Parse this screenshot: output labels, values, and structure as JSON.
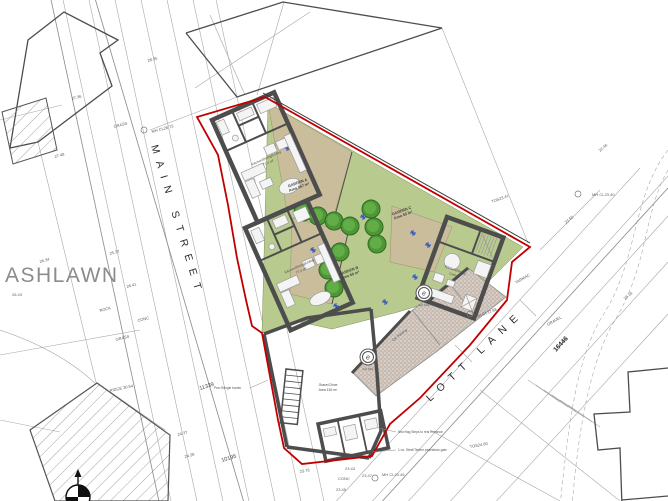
{
  "drawing": {
    "place_label": "ASHLAWN",
    "streets": [
      {
        "label": "MAIN STREET"
      },
      {
        "label": "LOTT LANE"
      }
    ],
    "chainage": [
      {
        "label": "16446"
      },
      {
        "label": "11339"
      },
      {
        "label": "10195"
      }
    ],
    "gardens": [
      {
        "name": "GARDEN A",
        "area": "Area 157 m²"
      },
      {
        "name": "GARDEN B",
        "area": "Area 60 m²"
      },
      {
        "name": "GARDEN C",
        "area": "Area 55 m²"
      }
    ],
    "rooms": {
      "house_a": {
        "line1": "Kitchen/Dining/Living",
        "line2": "77.4 m²"
      },
      "house_b": {
        "line1": "Kitchen/Dining/Living",
        "line2": "77.4 m²"
      },
      "house_c": {
        "line1": "Kitchen/Dining",
        "line2": "Living"
      },
      "yard": {
        "line1": "Gravel Drive",
        "line2": "Area 152 m²"
      }
    },
    "parking": {
      "space_symbol": "e",
      "area_label": "Car Parking",
      "space_label": "Car Park"
    },
    "callouts": [
      {
        "text": "Pea Shingle border"
      },
      {
        "text": "New flag Steps to rear entrance"
      },
      {
        "text": "1 no. Steel/Timber pedestrian gate"
      }
    ],
    "survey_labels": [
      {
        "t": "27.36",
        "x": 72,
        "y": 100,
        "r": -15
      },
      {
        "t": "27.48",
        "x": 55,
        "y": 158,
        "r": -15
      },
      {
        "t": "GRASS",
        "x": 114,
        "y": 128,
        "r": -15
      },
      {
        "t": "MH CL28.73",
        "x": 152,
        "y": 133,
        "r": -15
      },
      {
        "t": "28.35",
        "x": 148,
        "y": 62,
        "r": -15
      },
      {
        "t": "25.37",
        "x": 110,
        "y": 255,
        "r": -15
      },
      {
        "t": "26.34",
        "x": 40,
        "y": 263,
        "r": -15
      },
      {
        "t": "26.43",
        "x": 12,
        "y": 296,
        "r": 0
      },
      {
        "t": "26.41",
        "x": 127,
        "y": 288,
        "r": -15
      },
      {
        "t": "ROCK",
        "x": 100,
        "y": 312,
        "r": -15
      },
      {
        "t": "CONC",
        "x": 138,
        "y": 322,
        "r": -15
      },
      {
        "t": "GRASS",
        "x": 116,
        "y": 341,
        "r": -15
      },
      {
        "t": "RIDGE 30.54",
        "x": 110,
        "y": 392,
        "r": -12
      },
      {
        "t": "24.37",
        "x": 178,
        "y": 436,
        "r": -15
      },
      {
        "t": "24.28",
        "x": 185,
        "y": 458,
        "r": -15
      },
      {
        "t": "23.78",
        "x": 300,
        "y": 473,
        "r": -10
      },
      {
        "t": "23.43",
        "x": 345,
        "y": 470,
        "r": 0
      },
      {
        "t": "CONC",
        "x": 338,
        "y": 480,
        "r": 0
      },
      {
        "t": "23.47",
        "x": 362,
        "y": 477,
        "r": 0
      },
      {
        "t": "MH CL23.45",
        "x": 382,
        "y": 476,
        "r": 0
      },
      {
        "t": "23.45",
        "x": 336,
        "y": 491,
        "r": 0
      },
      {
        "t": "TOS23.41",
        "x": 492,
        "y": 203,
        "r": -20
      },
      {
        "t": "MH CL23.40",
        "x": 592,
        "y": 196,
        "r": 0
      },
      {
        "t": "23.55",
        "x": 566,
        "y": 224,
        "r": -40
      },
      {
        "t": "TARMAC",
        "x": 516,
        "y": 284,
        "r": -30
      },
      {
        "t": "GRAVEL",
        "x": 548,
        "y": 326,
        "r": -30
      },
      {
        "t": "MH CL22.88",
        "x": 476,
        "y": 318,
        "r": -20
      },
      {
        "t": "22.46",
        "x": 600,
        "y": 152,
        "r": -40
      },
      {
        "t": "23.18",
        "x": 625,
        "y": 300,
        "r": -40
      },
      {
        "t": "TOS24.60",
        "x": 470,
        "y": 448,
        "r": -10
      }
    ],
    "colors": {
      "boundary_red": "#c00000",
      "garden_green": "#b9ca8f",
      "garden_tan": "#c9bd9c",
      "parking_brown": "#c7bab1",
      "wall_grey": "#4d4d4d",
      "tree_green": "#4e9637",
      "marker_blue": "#2b50c8",
      "survey_grey": "#a8a8a8"
    }
  }
}
